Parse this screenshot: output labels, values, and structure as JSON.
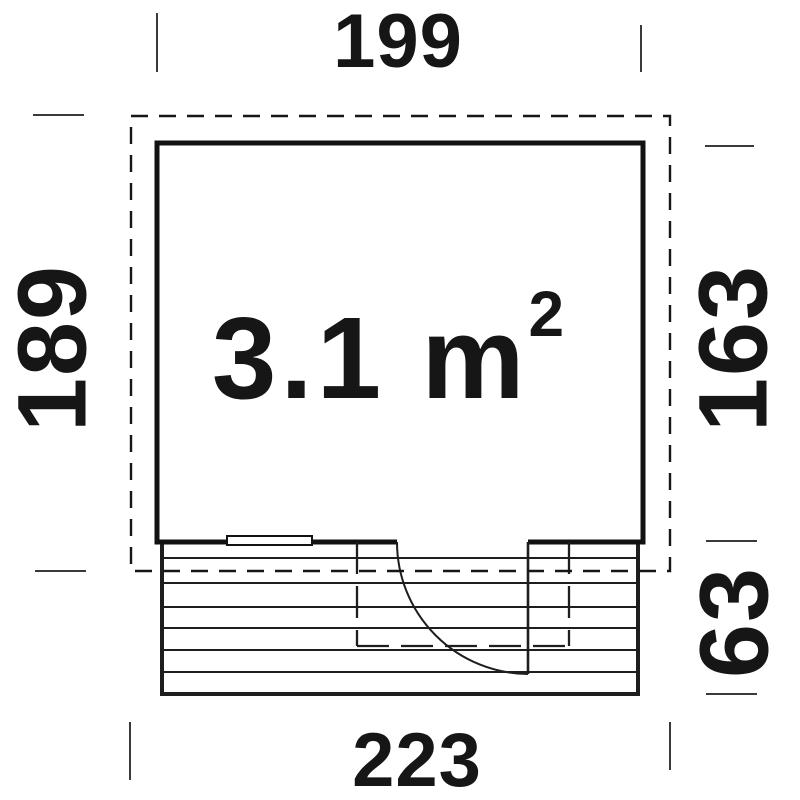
{
  "drawing": {
    "type": "floor-plan",
    "area_label": {
      "text": "3.1 m",
      "exponent": "2"
    },
    "dimensions": {
      "width_top": "199",
      "height_left": "189",
      "height_right": "163",
      "terrace_depth_right": "63",
      "width_bottom": "223"
    },
    "features": {
      "roof_outline": "dashed rectangle",
      "building": "solid walls",
      "window_bottom_wall": "double-line marking",
      "door": "opening with quarter-circle swing arc",
      "terrace": "7 horizontal deck boards",
      "canopy_over_door": "dashed rectangle"
    },
    "colors": {
      "background": "#ffffff",
      "line": "#121212",
      "text": "#161616",
      "tick": "#3a3a3a"
    }
  }
}
